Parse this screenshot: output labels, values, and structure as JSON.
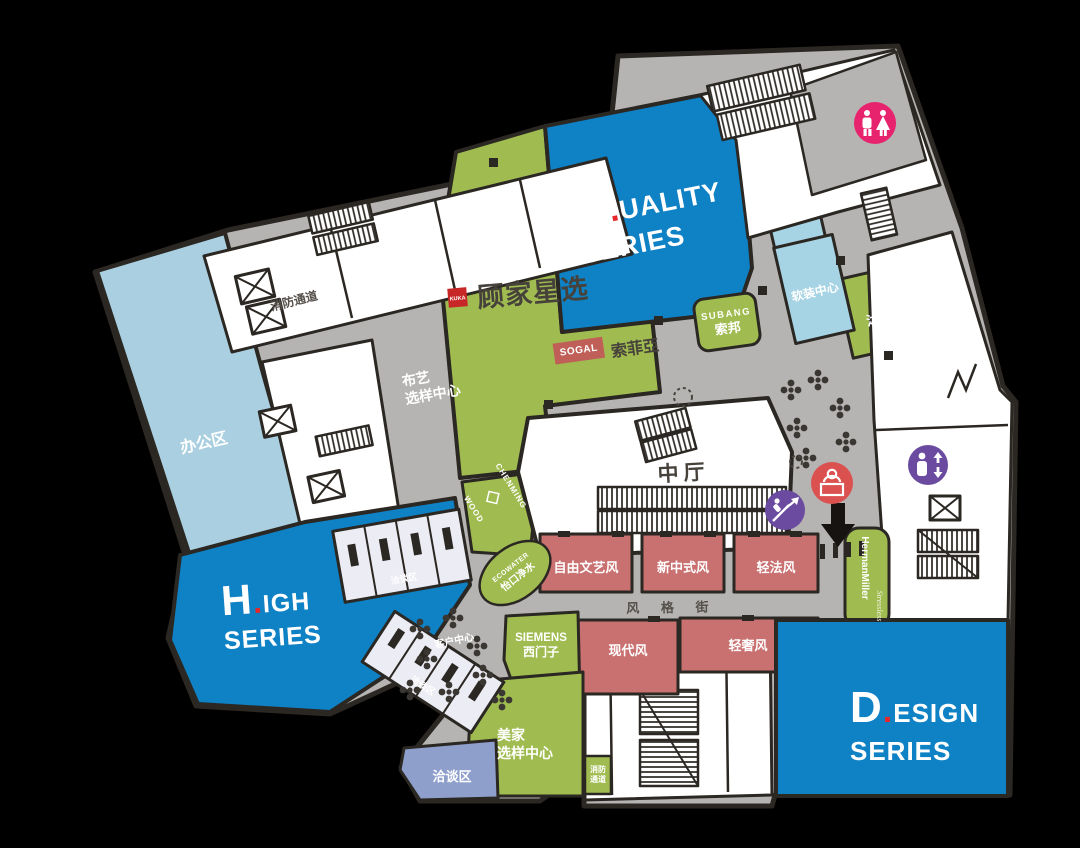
{
  "palette": {
    "background": "#000000",
    "corridor_gray": "#b5b4b2",
    "wall_dark": "#2b2722",
    "series_blue": "#0f81c5",
    "office_light_blue": "#a9cfe0",
    "soft_light_blue": "#a6d4e4",
    "zone_green": "#a0bc51",
    "style_red": "#c97070",
    "lounge_blue_violet": "#8f9fcc",
    "restroom_pink": "#e8236d",
    "icon_purple": "#6a4ba0",
    "service_red": "#db5150",
    "kuka_red": "#c82728",
    "sogal_red": "#bf5f57",
    "accent_red_dot": "#e8262a"
  },
  "series_blocks": {
    "quality": {
      "initial": "Q",
      "dot": ".",
      "rest": "UALITY",
      "line2": "SERIES"
    },
    "high": {
      "initial": "H",
      "dot": ".",
      "rest": "IGH",
      "line2": "SERIES"
    },
    "design": {
      "initial": "D",
      "dot": ".",
      "rest": "ESIGN",
      "line2": "SERIES"
    }
  },
  "brands": {
    "kuka": {
      "logo": "KUKA",
      "name": "顾家星选"
    },
    "sogal": {
      "logo": "SOGAL",
      "name": "索菲亞"
    },
    "subang": {
      "logo": "SUBANG",
      "name": "索邦"
    },
    "siemens": {
      "logo": "SIEMENS",
      "name": "西门子"
    },
    "herman_miller": {
      "name": "HermanMiller",
      "sub": "Stressless"
    },
    "chenming": {
      "line1": "CHENMING",
      "line2": "WOOD"
    },
    "ecowater": {
      "logo": "ECOWATER",
      "name": "怡口净水"
    }
  },
  "areas": {
    "office": "办公区",
    "fire_escape_top": "消防通道",
    "fabric_line1": "布艺",
    "fabric_line2": "选样中心",
    "atrium": "中厅",
    "live_room": "直播间",
    "soft_center": "软装中心",
    "muyi_lighting": "沐逸灯饰",
    "style_street": "风 格 街",
    "lounge": "洽谈区",
    "lounge_small_1": "洽谈区",
    "lounge_small_2": "洽谈区",
    "customer_center": "客户中心",
    "meijia_line1": "美家",
    "meijia_line2": "选样中心",
    "fire_b_line1": "消防",
    "fire_b_line2": "通道"
  },
  "style_zones": [
    "自由文艺风",
    "新中式风",
    "轻法风",
    "现代风",
    "轻奢风"
  ],
  "icons": {
    "restroom": "restroom-icon",
    "elevator": "elevator-icon",
    "escalator": "escalator-icon",
    "service_desk": "service-desk-icon",
    "down_arrow": "down-arrow-icon"
  }
}
